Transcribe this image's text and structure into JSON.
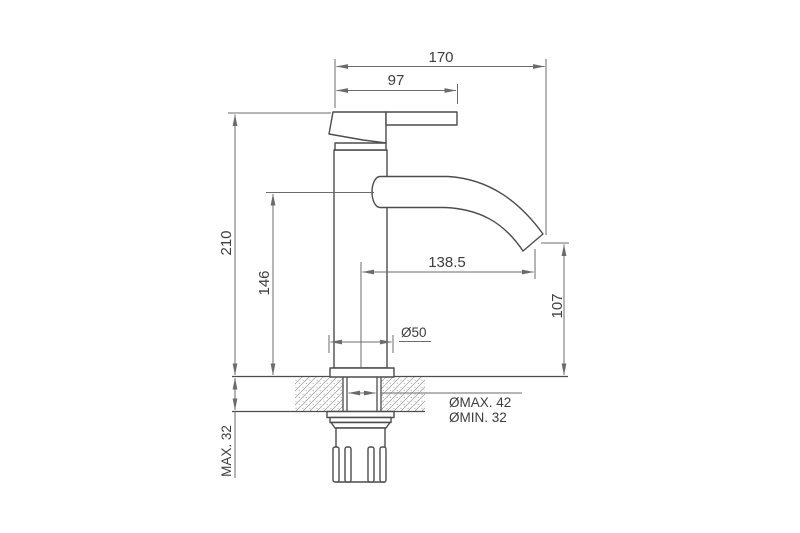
{
  "colors": {
    "line": "#4c4c4c",
    "dim": "#6b6b6b",
    "text": "#3d3d3d",
    "hatch": "#979797",
    "background": "#ffffff"
  },
  "dimensions": {
    "overall_width": "170",
    "handle_length": "97",
    "overall_height": "210",
    "spout_height": "146",
    "spout_reach": "138.5",
    "outlet_height": "107",
    "base_diameter": "Ø50",
    "hole_diameter_max": "ØMAX. 42",
    "hole_diameter_min": "ØMIN. 32",
    "deck_thickness_max": "MAX. 32"
  }
}
